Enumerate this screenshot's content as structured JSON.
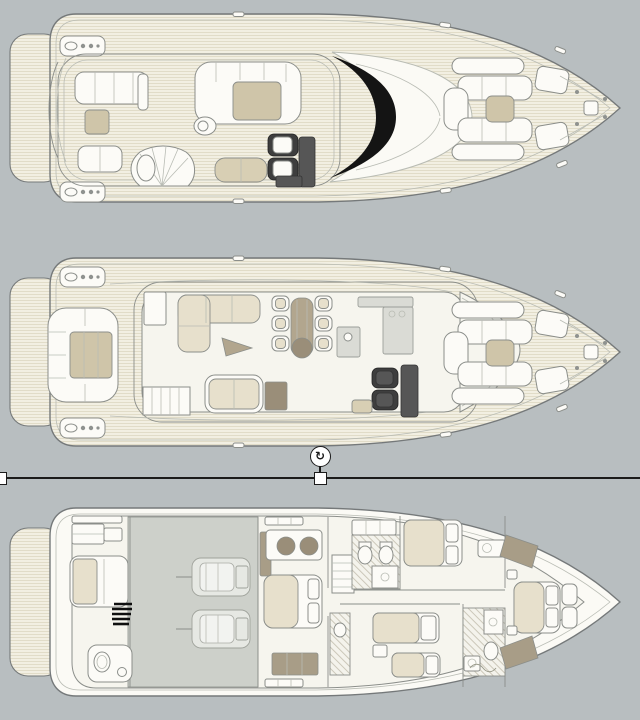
{
  "canvas": {
    "width": 640,
    "height": 720,
    "background": "#b8bec0"
  },
  "artwork": {
    "type": "yacht-deck-plans",
    "deck_count": 3,
    "decks": [
      {
        "id": "flybridge-deck",
        "position": "top",
        "features": [
          "swim-platform",
          "boarding-gate-platforms",
          "aft-sofa",
          "coffee-table",
          "aft-bench",
          "spiral-staircase",
          "u-sofa-with-table",
          "round-stool",
          "helm-seats",
          "helm-console",
          "sunpad",
          "windscreen",
          "foredeck-lounge",
          "foredeck-table",
          "foredeck-benches",
          "anchor-windlass"
        ]
      },
      {
        "id": "main-deck",
        "position": "middle",
        "features": [
          "swim-platform",
          "boarding-gate-platforms",
          "transom-sofa",
          "cockpit-table",
          "salon-floor",
          "l-sofa",
          "side-table",
          "dining-table",
          "dining-chairs",
          "galley",
          "lounge-sofa",
          "tv-cabinet",
          "companionway-stairs",
          "helm-seats",
          "helm-console",
          "windshield",
          "foredeck-lounge",
          "foredeck-table",
          "foredeck-benches",
          "anchor-windlass"
        ]
      },
      {
        "id": "lower-deck",
        "position": "bottom",
        "features": [
          "swim-platform",
          "crew-cabin",
          "crew-berth",
          "crew-wc",
          "ladder",
          "engine-room",
          "port-engine",
          "starboard-engine",
          "master-cabin",
          "master-berth",
          "twin-sinks",
          "wardrobe",
          "guest-bathroom",
          "toilet",
          "bidet",
          "shower",
          "guest-cabin-double",
          "guest-cabin-twin",
          "day-head",
          "vip-cabin",
          "vip-berth",
          "builder-signature"
        ]
      }
    ]
  },
  "selection": {
    "line_y": 477,
    "handle_size": 13,
    "handles_x": [
      0,
      320
    ],
    "rotate_handle": {
      "cx": 320,
      "cy": 456,
      "glyph": "↻"
    }
  },
  "palette": {
    "canvas_bg": "#b8bec0",
    "hull_fill": "#fbfaf5",
    "hull_stroke": "#75797a",
    "teak_base": "#f2efe2",
    "teak_line": "#ddd7c2",
    "interior_floor": "#f6f5ee",
    "furniture_white": "#fcfbf7",
    "cushion_beige": "#e7e0cc",
    "table_tan": "#cfc5a9",
    "sunpad_tan": "#d8cfb4",
    "taupe": "#b2a68e",
    "dark_taupe": "#9a8e79",
    "wardrobe_taupe": "#a89d87",
    "seat_dark": "#3e3e3e",
    "console_gray": "#565656",
    "windscreen_black": "#141414",
    "engine_room": "#cdd0ca",
    "galley_gray": "#dadbd5",
    "line_mid": "#8b8e8a",
    "line_light": "#b9bcb4",
    "selection_line": "#1b1b1b",
    "handle_fill": "#ffffff"
  }
}
